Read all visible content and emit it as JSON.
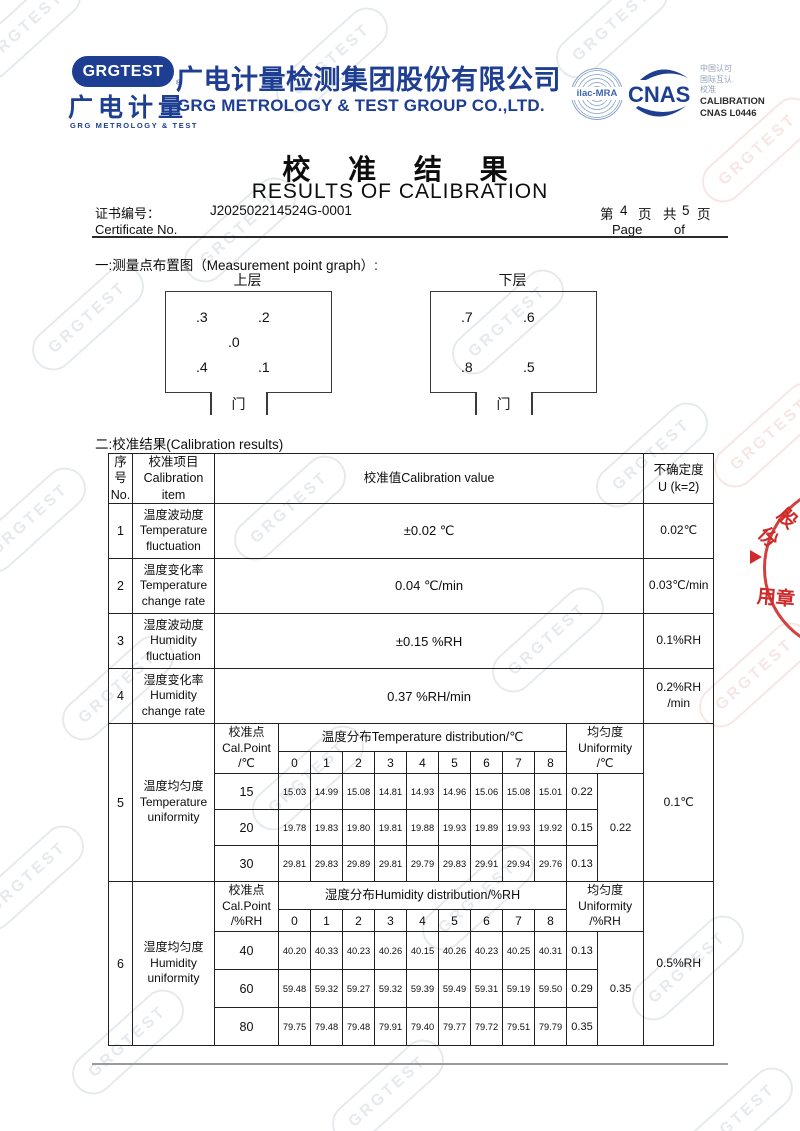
{
  "watermark_text": "GRGTEST",
  "header": {
    "logo_badge": "GRGTEST",
    "logo_reg": "®",
    "logo_cn": "广电计量",
    "logo_sub": "GRG METROLOGY & TEST",
    "company_cn": "广电计量检测集团股份有限公司",
    "company_en": "GRG METROLOGY & TEST GROUP CO.,LTD.",
    "ilac": "ilac-MRA",
    "cnas": "CNAS",
    "accred_zh1": "中国认可",
    "accred_zh2": "国际互认",
    "accred_zh3": "校准",
    "accred_en1": "CALIBRATION",
    "accred_en2": "CNAS L0446"
  },
  "title": {
    "cn": "校 准 结 果",
    "en": "RESULTS OF CALIBRATION"
  },
  "certificate": {
    "label_cn": "证书编号：",
    "number": "J202502214524G-0001",
    "label_en": "Certificate No.",
    "p1": "第",
    "page_no": "4",
    "p2": "页",
    "p3": "共",
    "page_total": "5",
    "p4": "页",
    "page_label": "Page",
    "of_label": "of"
  },
  "section1": "一:测量点布置图（Measurement point graph）:",
  "section2": "二:校准结果(Calibration results)",
  "graphs": {
    "upper": {
      "title": "上层",
      "points": [
        ".3",
        ".2",
        ".0",
        ".4",
        ".1"
      ],
      "door": "门"
    },
    "lower": {
      "title": "下层",
      "points": [
        ".7",
        ".6",
        ".8",
        ".5"
      ],
      "door": "门"
    }
  },
  "table": {
    "head": {
      "no": "序\n号\nNo.",
      "item": "校准项目\nCalibration\nitem",
      "value": "校准值Calibration value",
      "unc": "不确定度\nU (k=2)"
    },
    "rows": [
      {
        "no": "1",
        "item": "温度波动度\nTemperature\nfluctuation",
        "value": "±0.02 ℃",
        "unc": "0.02℃"
      },
      {
        "no": "2",
        "item": "温度变化率\nTemperature\nchange rate",
        "value": "0.04 ℃/min",
        "unc": "0.03℃/min"
      },
      {
        "no": "3",
        "item": "湿度波动度\nHumidity\nfluctuation",
        "value": "±0.15 %RH",
        "unc": "0.1%RH"
      },
      {
        "no": "4",
        "item": "湿度变化率\nHumidity\nchange rate",
        "value": "0.37 %RH/min",
        "unc": "0.2%RH\n/min"
      }
    ],
    "row5": {
      "no": "5",
      "item": "温度均匀度\nTemperature\nuniformity",
      "calpoint_label": "校准点\nCal.Point\n/℃",
      "dist_label": "温度分布Temperature distribution/℃",
      "uniformity_label": "均匀度\nUniformity\n/℃",
      "cols": [
        "0",
        "1",
        "2",
        "3",
        "4",
        "5",
        "6",
        "7",
        "8"
      ],
      "rows": [
        {
          "point": "15",
          "values": [
            "15.03",
            "14.99",
            "15.08",
            "14.81",
            "14.93",
            "14.96",
            "15.06",
            "15.08",
            "15.01"
          ],
          "uniformity": "0.22"
        },
        {
          "point": "20",
          "values": [
            "19.78",
            "19.83",
            "19.80",
            "19.81",
            "19.88",
            "19.93",
            "19.89",
            "19.93",
            "19.92"
          ],
          "uniformity": "0.15"
        },
        {
          "point": "30",
          "values": [
            "29.81",
            "29.83",
            "29.89",
            "29.81",
            "29.79",
            "29.83",
            "29.91",
            "29.94",
            "29.76"
          ],
          "uniformity": "0.13"
        }
      ],
      "uniformity_overall": "0.22",
      "unc": "0.1℃"
    },
    "row6": {
      "no": "6",
      "item": "湿度均匀度\nHumidity\nuniformity",
      "calpoint_label": "校准点\nCal.Point\n/%RH",
      "dist_label": "湿度分布Humidity distribution/%RH",
      "uniformity_label": "均匀度\nUniformity\n/%RH",
      "cols": [
        "0",
        "1",
        "2",
        "3",
        "4",
        "5",
        "6",
        "7",
        "8"
      ],
      "rows": [
        {
          "point": "40",
          "values": [
            "40.20",
            "40.33",
            "40.23",
            "40.26",
            "40.15",
            "40.26",
            "40.23",
            "40.25",
            "40.31"
          ],
          "uniformity": "0.13"
        },
        {
          "point": "60",
          "values": [
            "59.48",
            "59.32",
            "59.27",
            "59.32",
            "59.39",
            "59.49",
            "59.31",
            "59.19",
            "59.50"
          ],
          "uniformity": "0.29"
        },
        {
          "point": "80",
          "values": [
            "79.75",
            "79.48",
            "79.48",
            "79.91",
            "79.40",
            "79.77",
            "79.72",
            "79.51",
            "79.79"
          ],
          "uniformity": "0.35"
        }
      ],
      "uniformity_overall": "0.35",
      "unc": "0.5%RH"
    }
  },
  "stamp": {
    "top": "股份",
    "bottom": "用章"
  },
  "colors": {
    "brand_navy": "#1e3e92",
    "stamp_red": "#cf2b2b"
  }
}
